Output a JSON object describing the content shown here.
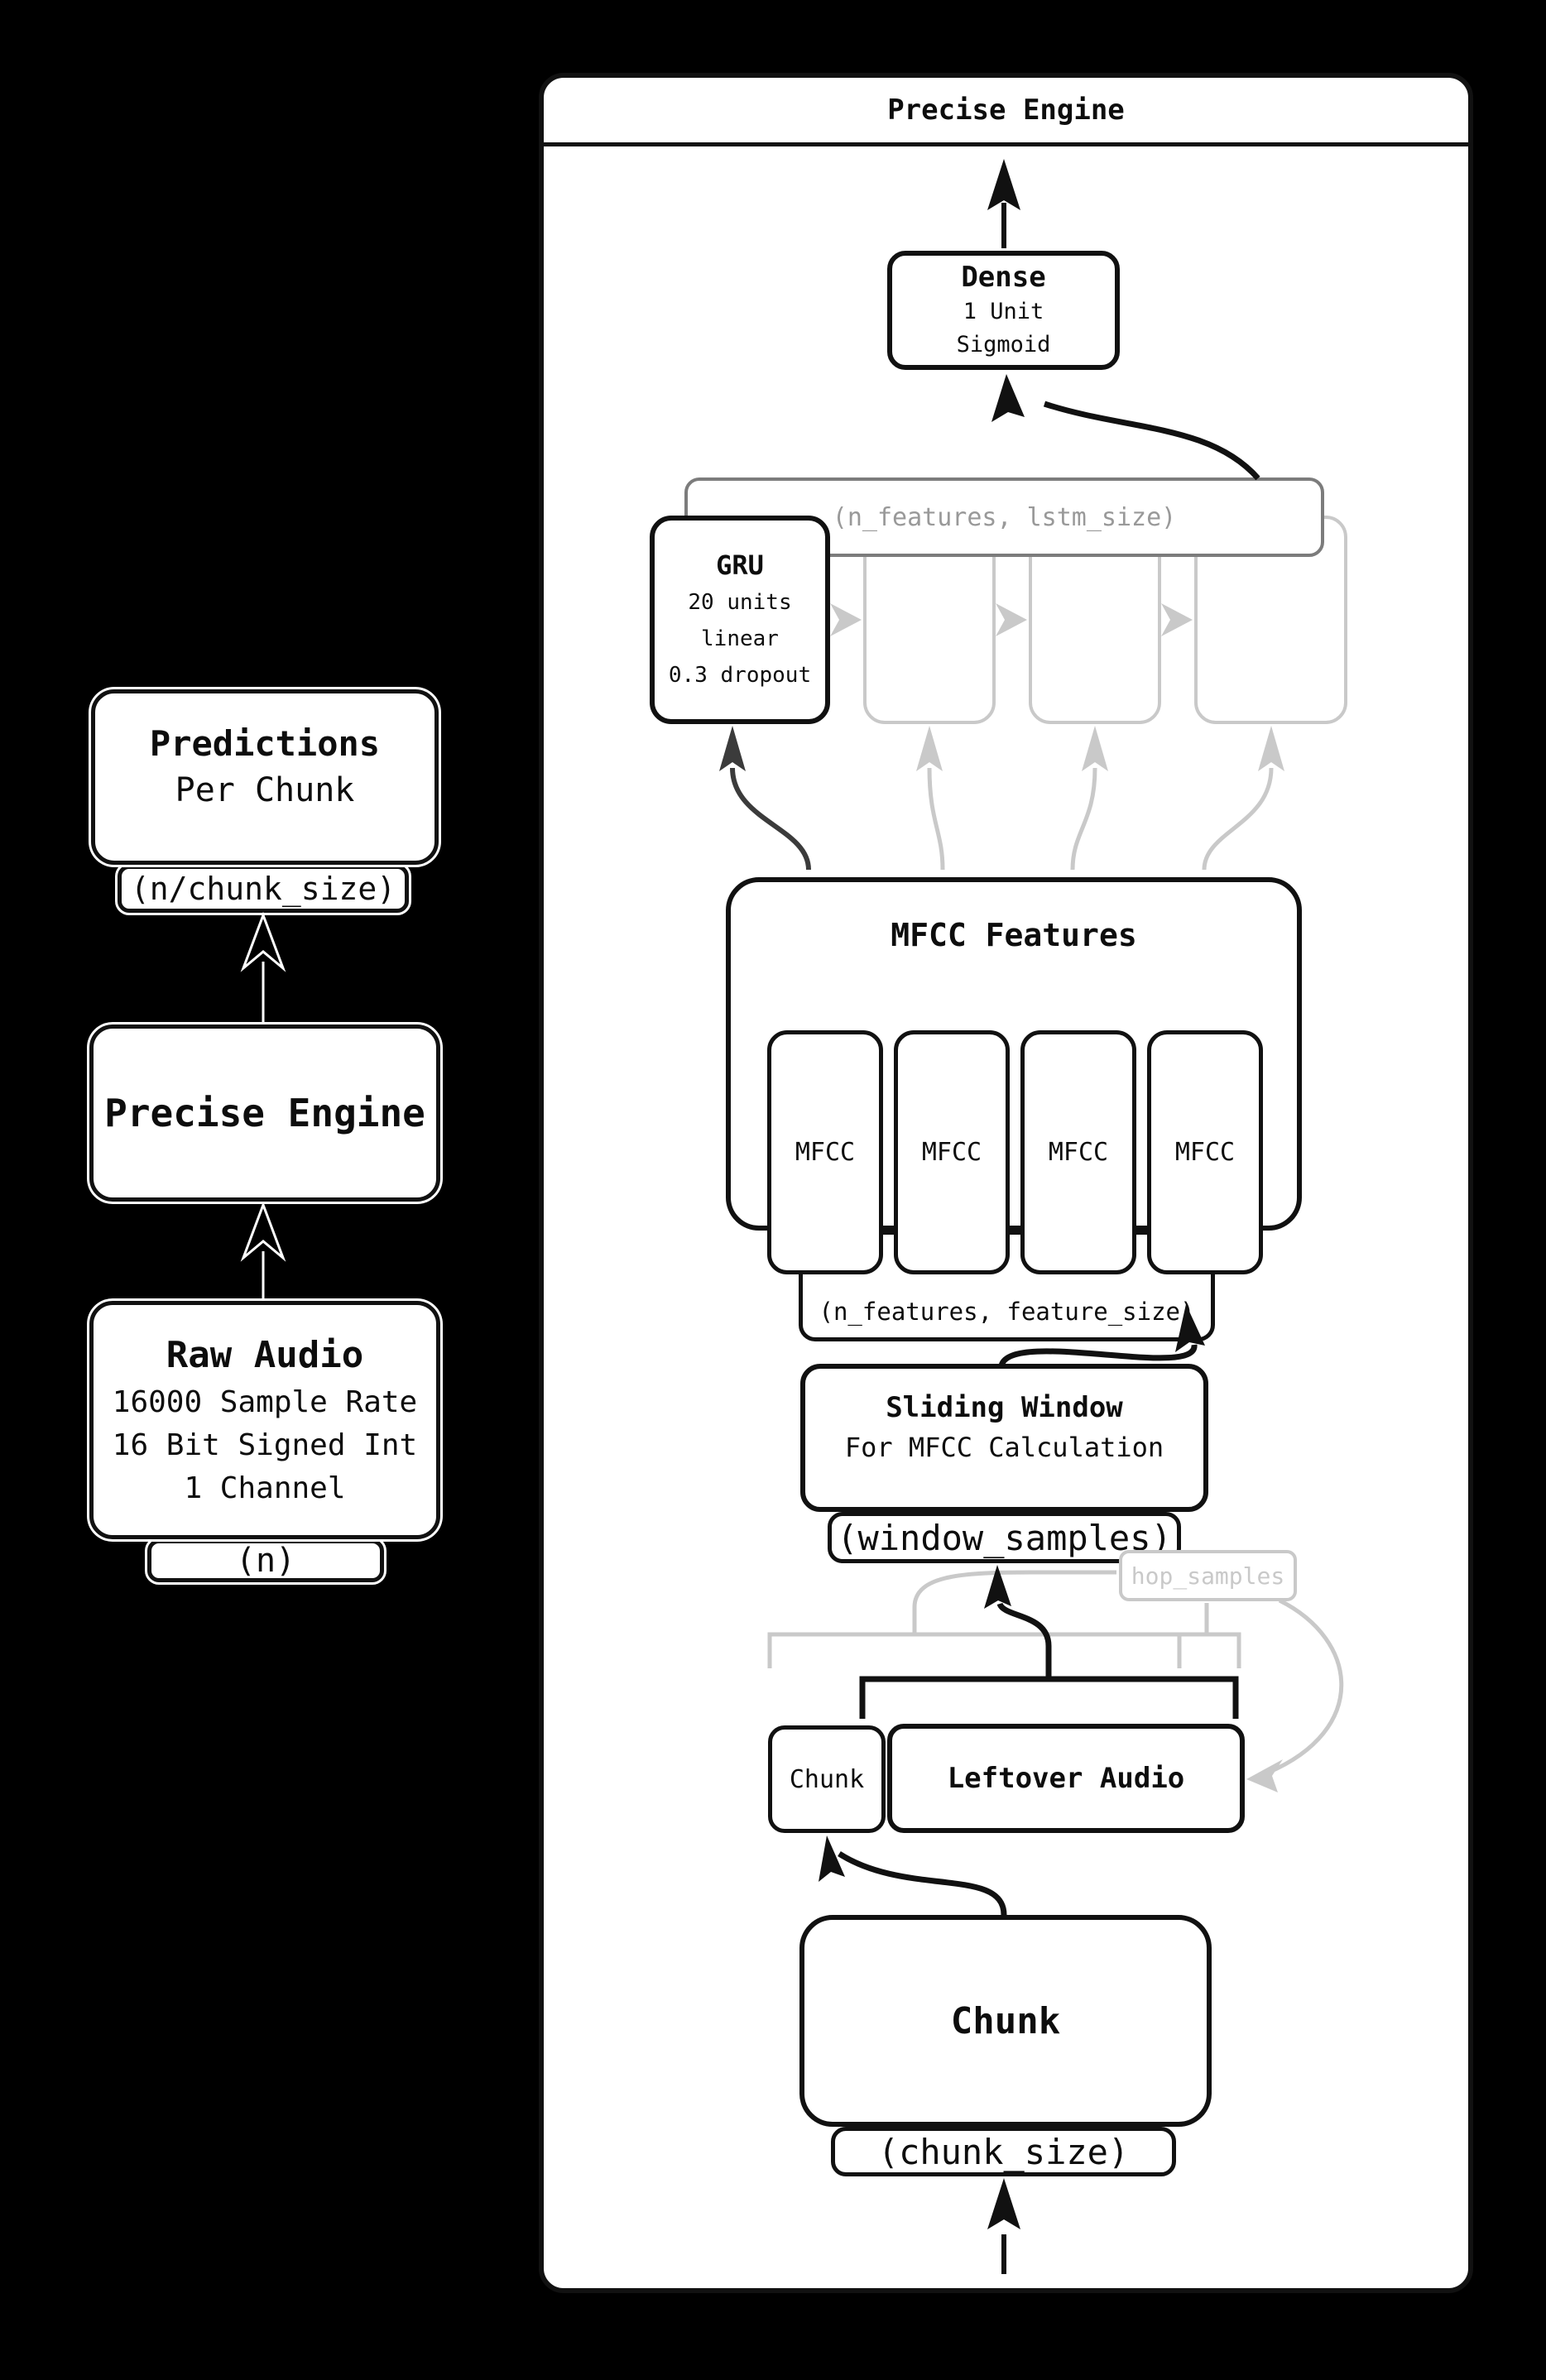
{
  "overview": {
    "predictions": {
      "title": "Predictions",
      "subtitle": "Per Chunk",
      "tab": "(n/chunk_size)"
    },
    "engine": {
      "title": "Precise Engine"
    },
    "raw_audio": {
      "title": "Raw Audio",
      "line1": "16000 Sample Rate",
      "line2": "16 Bit Signed Int",
      "line3": "1 Channel",
      "tab": "(n)"
    }
  },
  "panel": {
    "title": "Precise Engine",
    "dense": {
      "title": "Dense",
      "line1": "1 Unit",
      "line2": "Sigmoid"
    },
    "lstm_shape_label": "(n_features, lstm_size)",
    "gru": {
      "title": "GRU",
      "line1": "20 units",
      "line2": "linear",
      "line3": "0.3 dropout"
    },
    "mfcc": {
      "title": "MFCC Features",
      "cells": [
        "MFCC",
        "MFCC",
        "MFCC",
        "MFCC"
      ],
      "tab": "(n_features, feature_size)"
    },
    "sliding_window": {
      "title": "Sliding Window",
      "subtitle": "For MFCC Calculation",
      "tab": "(window_samples)"
    },
    "hop_label": "hop_samples",
    "buffer": {
      "chunk": "Chunk",
      "leftover": "Leftover Audio"
    },
    "chunk": {
      "title": "Chunk",
      "tab": "(chunk_size)"
    }
  },
  "colors": {
    "ink": "#111111",
    "faded": "#c9c9c9",
    "shape_box_border": "#7c7c7c",
    "shape_box_text": "#999999",
    "dark_arrow": "#3b3b3b",
    "background": "#000000"
  }
}
